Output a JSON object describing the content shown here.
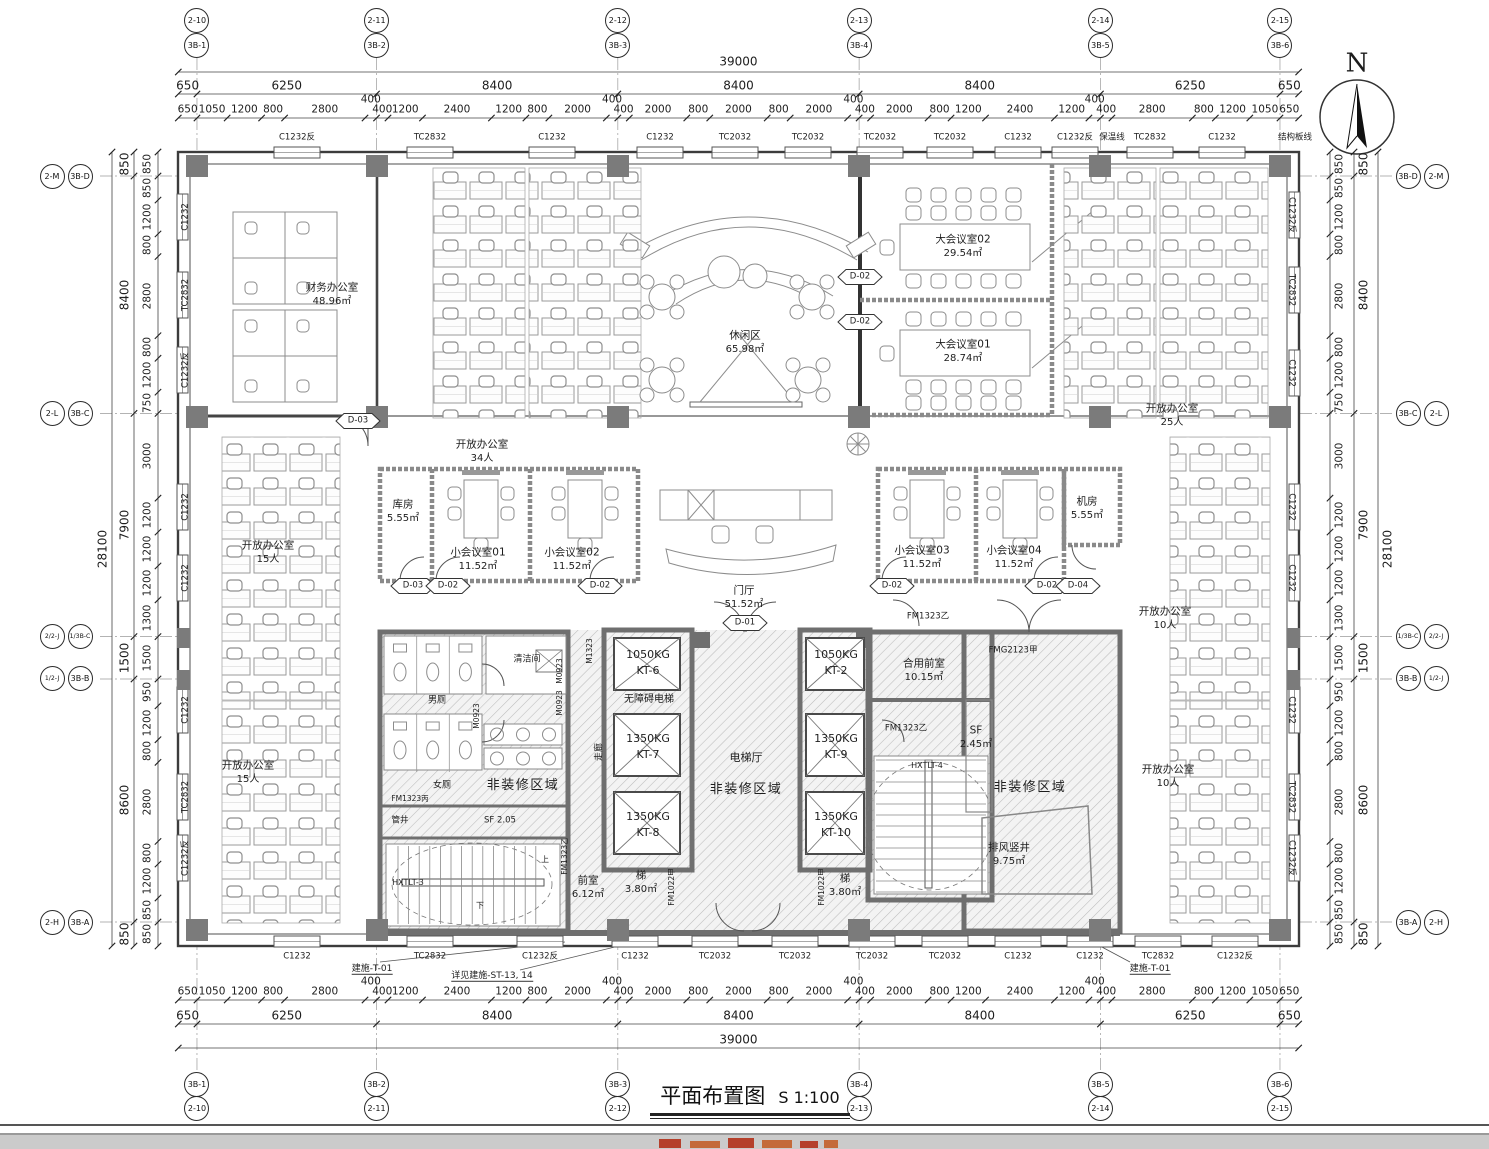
{
  "sheet": {
    "title": "平面布置图",
    "scale": "S 1:100",
    "north_label": "N"
  },
  "grid": {
    "top": [
      {
        "a": "2-10",
        "b": "3B-1",
        "mm": 650
      },
      {
        "a": "2-11",
        "b": "3B-2",
        "mm": 6900
      },
      {
        "a": "2-12",
        "b": "3B-3",
        "mm": 15300
      },
      {
        "a": "2-13",
        "b": "3B-4",
        "mm": 23700
      },
      {
        "a": "2-14",
        "b": "3B-5",
        "mm": 32100
      },
      {
        "a": "2-15",
        "b": "3B-6",
        "mm": 38350
      }
    ],
    "bottom": [
      {
        "a": "3B-1",
        "b": "2-10",
        "mm": 650
      },
      {
        "a": "3B-2",
        "b": "2-11",
        "mm": 6900
      },
      {
        "a": "3B-3",
        "b": "2-12",
        "mm": 15300
      },
      {
        "a": "3B-4",
        "b": "2-13",
        "mm": 23700
      },
      {
        "a": "3B-5",
        "b": "2-14",
        "mm": 32100
      },
      {
        "a": "3B-6",
        "b": "2-15",
        "mm": 38350
      }
    ],
    "left": [
      {
        "a": "2-M",
        "b": "3B-D",
        "mm": 850
      },
      {
        "a": "2-L",
        "b": "3B-C",
        "mm": 9250
      },
      {
        "a": "2/2-J",
        "b": "1/3B-C",
        "mm": 17150
      },
      {
        "a": "1/2-J",
        "b": "3B-B",
        "mm": 18650
      },
      {
        "a": "2-H",
        "b": "3B-A",
        "mm": 27250
      }
    ],
    "right": [
      {
        "a": "3B-D",
        "b": "2-M",
        "mm": 850
      },
      {
        "a": "3B-C",
        "b": "2-L",
        "mm": 9250
      },
      {
        "a": "1/3B-C",
        "b": "2/2-J",
        "mm": 17150
      },
      {
        "a": "3B-B",
        "b": "1/2-J",
        "mm": 18650
      },
      {
        "a": "3B-A",
        "b": "2-H",
        "mm": 27250
      }
    ]
  },
  "dimensions": {
    "horizontal": {
      "overall": 39000,
      "majors": [
        650,
        6250,
        8400,
        8400,
        8400,
        6250,
        650
      ],
      "minors": [
        650,
        1050,
        1200,
        800,
        2800,
        400,
        400,
        1200,
        2400,
        1200,
        800,
        2000,
        400,
        400,
        2000,
        800,
        2000,
        800,
        2000,
        400,
        400,
        2000,
        800,
        1200,
        2400,
        1200,
        400,
        400,
        2800,
        800,
        1200,
        1050,
        650
      ]
    },
    "vertical": {
      "overall": 28100,
      "majors": [
        850,
        8400,
        7900,
        1500,
        8600,
        850
      ],
      "minors": [
        850,
        850,
        1200,
        800,
        2800,
        800,
        1200,
        750,
        3000,
        1200,
        1200,
        1200,
        1300,
        1500,
        950,
        1200,
        800,
        2800,
        800,
        1200,
        850,
        850
      ]
    }
  },
  "window_tags": {
    "top": [
      {
        "t": "C1232反",
        "x": 297
      },
      {
        "t": "TC2832",
        "x": 430
      },
      {
        "t": "C1232",
        "x": 552
      },
      {
        "t": "C1232",
        "x": 660
      },
      {
        "t": "TC2032",
        "x": 735
      },
      {
        "t": "TC2032",
        "x": 808
      },
      {
        "t": "TC2032",
        "x": 880
      },
      {
        "t": "TC2032",
        "x": 950
      },
      {
        "t": "C1232",
        "x": 1018
      },
      {
        "t": "C1232反",
        "x": 1075
      },
      {
        "t": "保温线",
        "x": 1112,
        "note": true
      },
      {
        "t": "TC2832",
        "x": 1150
      },
      {
        "t": "C1232",
        "x": 1222
      },
      {
        "t": "结构板线",
        "x": 1295,
        "note": true
      }
    ],
    "bottom": [
      {
        "t": "C1232",
        "x": 297
      },
      {
        "t": "TC2832",
        "x": 430
      },
      {
        "t": "C1232反",
        "x": 540
      },
      {
        "t": "C1232",
        "x": 635
      },
      {
        "t": "TC2032",
        "x": 715
      },
      {
        "t": "TC2032",
        "x": 795
      },
      {
        "t": "TC2032",
        "x": 872
      },
      {
        "t": "TC2032",
        "x": 945
      },
      {
        "t": "C1232",
        "x": 1018
      },
      {
        "t": "C1232",
        "x": 1090
      },
      {
        "t": "TC2832",
        "x": 1158
      },
      {
        "t": "C1232反",
        "x": 1235
      }
    ],
    "left": [
      {
        "t": "C1232",
        "y": 217
      },
      {
        "t": "TC2832",
        "y": 295
      },
      {
        "t": "C1232反",
        "y": 370
      },
      {
        "t": "C1232",
        "y": 507
      },
      {
        "t": "C1232",
        "y": 578
      },
      {
        "t": "C1232",
        "y": 710
      },
      {
        "t": "TC2832",
        "y": 797
      },
      {
        "t": "C1232反",
        "y": 858
      }
    ],
    "right": [
      {
        "t": "C1232反",
        "y": 215
      },
      {
        "t": "TC2832",
        "y": 290
      },
      {
        "t": "C1232",
        "y": 373
      },
      {
        "t": "C1232",
        "y": 507
      },
      {
        "t": "C1232",
        "y": 578
      },
      {
        "t": "C1232",
        "y": 710
      },
      {
        "t": "TC2832",
        "y": 797
      },
      {
        "t": "C1232反",
        "y": 858
      }
    ]
  },
  "rooms": [
    {
      "n": "财务办公室",
      "a": "48.96㎡",
      "x": 332,
      "y": 295
    },
    {
      "n": "休闲区",
      "a": "65.98㎡",
      "x": 745,
      "y": 343
    },
    {
      "n": "大会议室02",
      "a": "29.54㎡",
      "x": 963,
      "y": 247
    },
    {
      "n": "大会议室01",
      "a": "28.74㎡",
      "x": 963,
      "y": 352
    },
    {
      "n": "开放办公室",
      "a": "25人",
      "x": 1172,
      "y": 416
    },
    {
      "n": "开放办公室",
      "a": "34人",
      "x": 482,
      "y": 452
    },
    {
      "n": "开放办公室",
      "a": "15人",
      "x": 268,
      "y": 553
    },
    {
      "n": "开放办公室",
      "a": "15人",
      "x": 248,
      "y": 773
    },
    {
      "n": "开放办公室",
      "a": "10人",
      "x": 1165,
      "y": 619
    },
    {
      "n": "开放办公室",
      "a": "10人",
      "x": 1168,
      "y": 777
    },
    {
      "n": "库房",
      "a": "5.55㎡",
      "x": 403,
      "y": 512
    },
    {
      "n": "小会议室01",
      "a": "11.52㎡",
      "x": 478,
      "y": 560
    },
    {
      "n": "小会议室02",
      "a": "11.52㎡",
      "x": 572,
      "y": 560
    },
    {
      "n": "小会议室03",
      "a": "11.52㎡",
      "x": 922,
      "y": 558
    },
    {
      "n": "小会议室04",
      "a": "11.52㎡",
      "x": 1014,
      "y": 558
    },
    {
      "n": "机房",
      "a": "5.55㎡",
      "x": 1087,
      "y": 509
    },
    {
      "n": "门厅",
      "a": "51.52㎡",
      "x": 744,
      "y": 598
    },
    {
      "n": "合用前室",
      "a": "10.15㎡",
      "x": 924,
      "y": 671
    },
    {
      "n": "排风竖井",
      "a": "9.75㎡",
      "x": 1009,
      "y": 855
    },
    {
      "n": "前室",
      "a": "6.12㎡",
      "x": 588,
      "y": 888
    },
    {
      "n": "梯",
      "a": "3.80㎡",
      "x": 641,
      "y": 883
    },
    {
      "n": "梯",
      "a": "3.80㎡",
      "x": 845,
      "y": 886
    },
    {
      "n": "SF",
      "a": "2.45㎡",
      "x": 976,
      "y": 738
    }
  ],
  "labels": [
    {
      "t": "非装修区域",
      "x": 523,
      "y": 786,
      "s": 13
    },
    {
      "t": "非装修区域",
      "x": 746,
      "y": 790,
      "s": 13
    },
    {
      "t": "非装修区域",
      "x": 1030,
      "y": 788,
      "s": 13
    },
    {
      "t": "电梯厅",
      "x": 746,
      "y": 758,
      "s": 11
    },
    {
      "t": "走廊",
      "x": 600,
      "y": 752,
      "rot": -90,
      "s": 9
    },
    {
      "t": "清洁间",
      "x": 527,
      "y": 660,
      "s": 9
    },
    {
      "t": "男厕",
      "x": 437,
      "y": 701,
      "s": 9
    },
    {
      "t": "女厕",
      "x": 442,
      "y": 786,
      "s": 9
    },
    {
      "t": "管井",
      "x": 400,
      "y": 821,
      "s": 8.5
    },
    {
      "t": "SF 2.05",
      "x": 500,
      "y": 821,
      "s": 8.5
    },
    {
      "t": "无障碍电梯",
      "x": 649,
      "y": 700,
      "s": 10
    },
    {
      "t": "HXTLT-3",
      "x": 408,
      "y": 883,
      "s": 8
    },
    {
      "t": "HXTLT-4",
      "x": 927,
      "y": 766,
      "s": 8
    },
    {
      "t": "上",
      "x": 545,
      "y": 860,
      "s": 8
    },
    {
      "t": "下",
      "x": 480,
      "y": 906,
      "s": 8
    },
    {
      "t": "M1323",
      "x": 590,
      "y": 651,
      "rot": -90,
      "s": 7.5
    },
    {
      "t": "M0923",
      "x": 560,
      "y": 671,
      "rot": -90,
      "s": 7.5
    },
    {
      "t": "M0923",
      "x": 560,
      "y": 703,
      "rot": -90,
      "s": 7.5
    },
    {
      "t": "M0923",
      "x": 477,
      "y": 716,
      "rot": -90,
      "s": 7.5
    },
    {
      "t": "FM1323丙",
      "x": 410,
      "y": 799,
      "s": 7.5
    },
    {
      "t": "FM1323乙",
      "x": 565,
      "y": 856,
      "rot": -90,
      "s": 7.5
    },
    {
      "t": "FM1323乙",
      "x": 928,
      "y": 617,
      "s": 8.5
    },
    {
      "t": "FM1323乙",
      "x": 906,
      "y": 729,
      "s": 8.5
    },
    {
      "t": "FM1022甲",
      "x": 672,
      "y": 887,
      "rot": -90,
      "s": 7.5
    },
    {
      "t": "FM1022甲",
      "x": 822,
      "y": 887,
      "rot": -90,
      "s": 7.5
    },
    {
      "t": "FMG2123甲",
      "x": 1013,
      "y": 651,
      "s": 8.5
    }
  ],
  "door_tags": [
    {
      "t": "D-03",
      "x": 358,
      "y": 421
    },
    {
      "t": "D-02",
      "x": 860,
      "y": 277
    },
    {
      "t": "D-02",
      "x": 860,
      "y": 322
    },
    {
      "t": "D-03",
      "x": 413,
      "y": 586
    },
    {
      "t": "D-02",
      "x": 448,
      "y": 586
    },
    {
      "t": "D-02",
      "x": 600,
      "y": 586
    },
    {
      "t": "D-02",
      "x": 892,
      "y": 586
    },
    {
      "t": "D-02",
      "x": 1047,
      "y": 586
    },
    {
      "t": "D-04",
      "x": 1078,
      "y": 586
    },
    {
      "t": "D-01",
      "x": 745,
      "y": 623
    }
  ],
  "elevators": [
    {
      "load": "1050KG",
      "id": "KT-6",
      "x": 648,
      "y": 663
    },
    {
      "load": "1350KG",
      "id": "KT-7",
      "x": 648,
      "y": 747
    },
    {
      "load": "1350KG",
      "id": "KT-8",
      "x": 648,
      "y": 825
    },
    {
      "load": "1050KG",
      "id": "KT-2",
      "x": 836,
      "y": 663
    },
    {
      "load": "1350KG",
      "id": "KT-9",
      "x": 836,
      "y": 747
    },
    {
      "load": "1350KG",
      "id": "KT-10",
      "x": 836,
      "y": 825
    }
  ],
  "annotations": [
    {
      "t": "建施-T-01",
      "x": 372,
      "y": 970
    },
    {
      "t": "详见建施-ST-13, 14",
      "x": 492,
      "y": 977
    },
    {
      "t": "建施-T-01",
      "x": 1150,
      "y": 970
    }
  ]
}
